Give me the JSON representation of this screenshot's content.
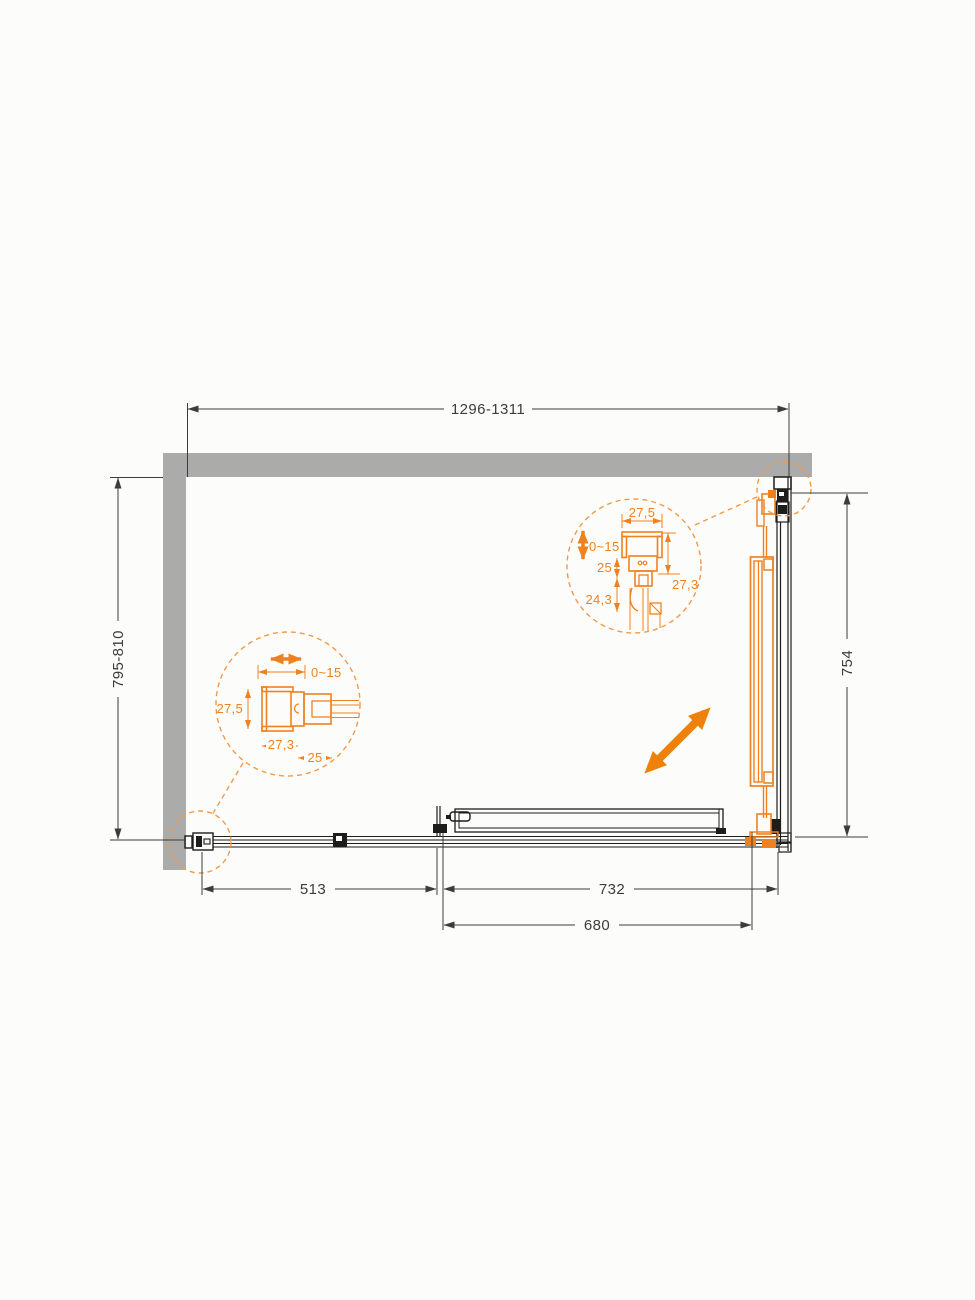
{
  "page": {
    "background": "#FCFCFA"
  },
  "drawing": {
    "subject": "shower-enclosure-installation-plan",
    "colors": {
      "accent": "#EF8220",
      "open_arrow": "#EE8109",
      "wall": "#ABABAB",
      "line": "#1D1D1B",
      "dimension_text": "#3C3C3B"
    },
    "dimensions": {
      "width_range": "1296-1311",
      "depth_range": "795-810",
      "side_panel": "754",
      "fixed_segment": "513",
      "door_width": "732",
      "opening_width": "680"
    },
    "detail_top": {
      "profile_width": "27,5",
      "adjust_range": "0~15",
      "inner_height": "25",
      "lower_height": "24,3",
      "total_height": "27,3"
    },
    "detail_side": {
      "adjust_range": "0~15",
      "profile_height": "27,5",
      "profile_width": "27,3",
      "clamp_width": "25"
    }
  }
}
